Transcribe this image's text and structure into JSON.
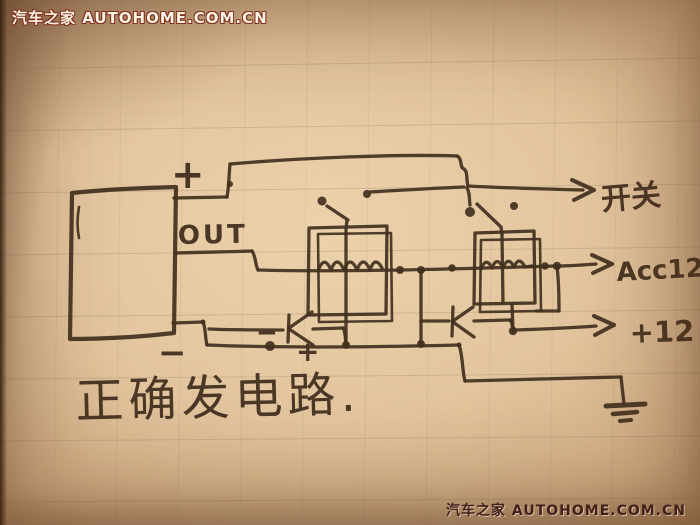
{
  "watermarks": {
    "top_left": "汽车之家 AUTOHOME.COM.CN",
    "bottom_right": "汽车之家 AUTOHOME.COM.CN"
  },
  "circuit": {
    "caption": "正确发电路.",
    "source": {
      "out_label": "OUT",
      "positive": "+",
      "negative": "−"
    },
    "outputs": {
      "switch": "开关",
      "acc": "Acc12",
      "power": "+12"
    },
    "diode1": {
      "minus": "−",
      "plus": "+"
    },
    "colors": {
      "ink": "#43301f",
      "paper": "#e2c59e",
      "watermark_top": "#fdf4e6",
      "watermark_bottom": "#41201a"
    }
  }
}
